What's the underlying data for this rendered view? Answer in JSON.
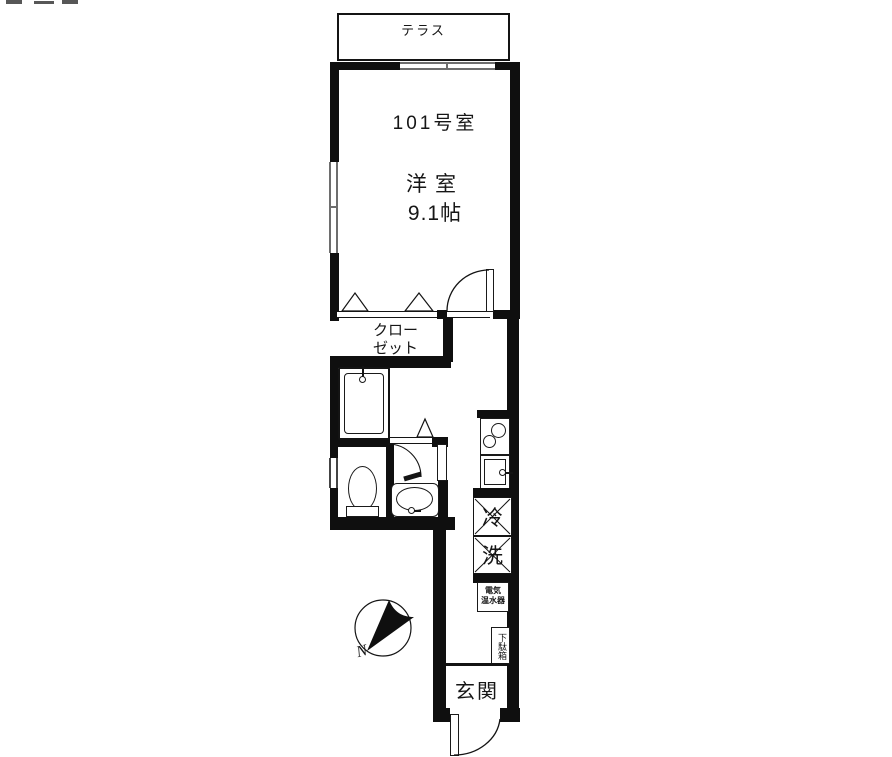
{
  "plan": {
    "terrace": {
      "label": "テラス"
    },
    "main_room": {
      "number": "101号室",
      "type": "洋室",
      "size": "9.1帖"
    },
    "closet": {
      "line1": "クロー",
      "line2": "ゼット"
    },
    "fixtures": {
      "fridge": "冷",
      "washer": "洗",
      "heater_line1": "電気",
      "heater_line2": "温水器",
      "shoebox": "下駄箱"
    },
    "entrance": {
      "label": "玄関"
    },
    "compass": {
      "north": "N"
    },
    "colors": {
      "wall": "#111111",
      "window_line": "#6e6e6e",
      "background": "#ffffff"
    }
  }
}
